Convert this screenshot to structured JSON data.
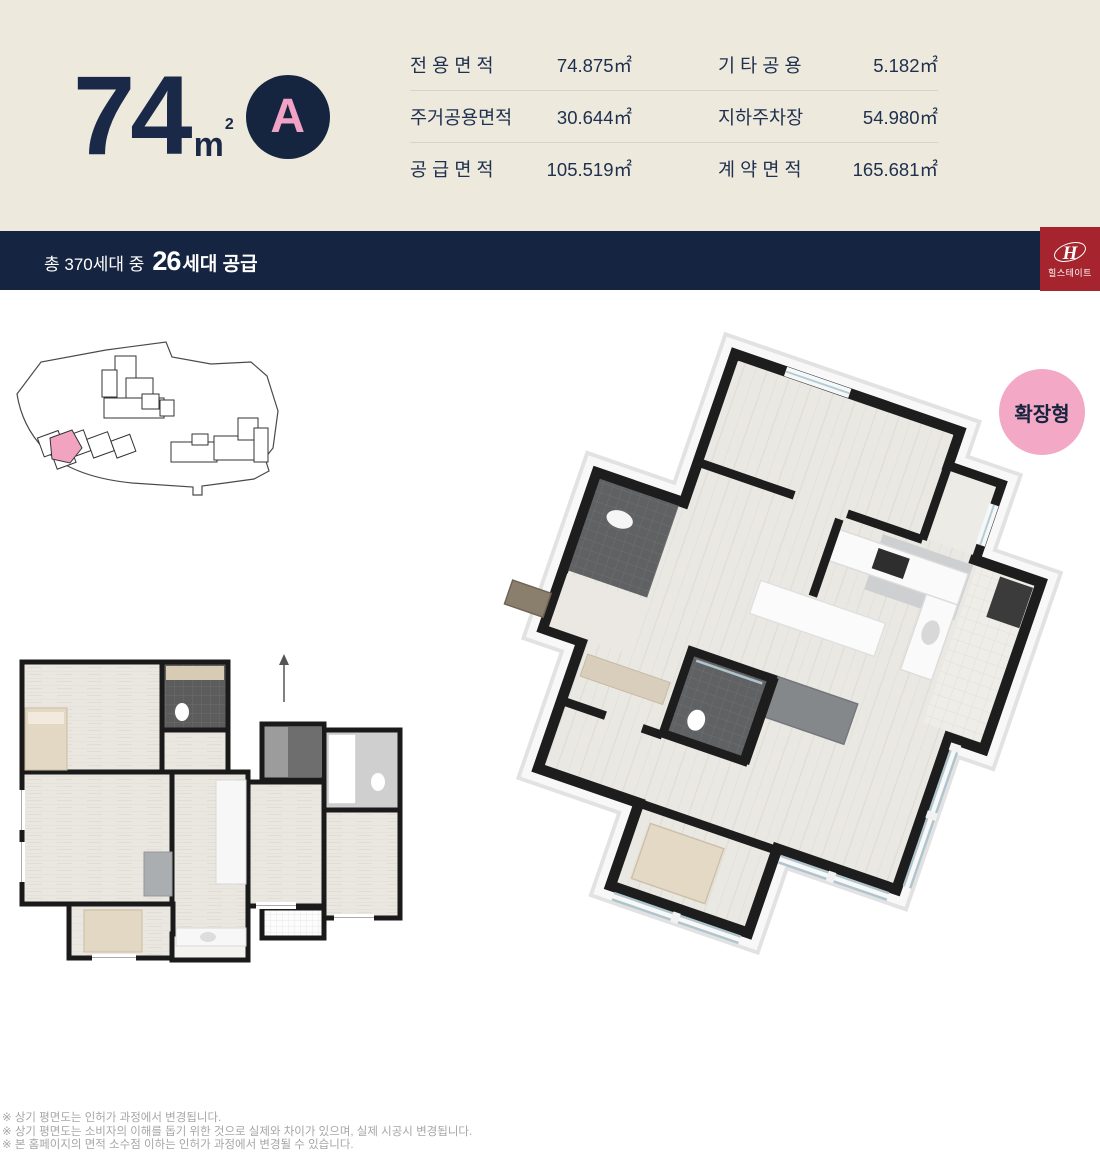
{
  "header": {
    "area_value": "74",
    "area_unit": "m",
    "area_unit_sup": "2",
    "type_badge": "A",
    "table": {
      "rows": [
        {
          "label_left": "전 용 면 적",
          "value_left": "74.875㎡",
          "label_right": "기 타 공 용",
          "value_right": "5.182㎡"
        },
        {
          "label_left": "주거공용면적",
          "value_left": "30.644㎡",
          "label_right": "지하주차장",
          "value_right": "54.980㎡"
        },
        {
          "label_left": "공 급 면 적",
          "value_left": "105.519㎡",
          "label_right": "계 약 면 적",
          "value_right": "165.681㎡"
        }
      ]
    }
  },
  "supply_bar": {
    "prefix": "총 370세대 중",
    "count": "26",
    "suffix": "세대 공급"
  },
  "logo": {
    "monogram": "H",
    "brand": "힐스테이트"
  },
  "extension_badge": {
    "label": "확장형"
  },
  "disclaimers": [
    "※ 상기 평면도는 인허가 과정에서 변경됩니다.",
    "※ 상기 평면도는 소비자의 이해를 돕기 위한 것으로 실제와 차이가 있으며, 실제 시공시 변경됩니다.",
    "※ 본 홈페이지의 면적 소수점 이하는 인허가 과정에서 변경될 수 있습니다."
  ],
  "colors": {
    "navy": "#152440",
    "text_navy": "#20304F",
    "beige_header": "#EDE9DC",
    "pink_accent": "#F2A2C4",
    "pink_badge": "#F3A8C6",
    "pink_unit": "#F2A3BF",
    "brand_red": "#A5242D"
  }
}
